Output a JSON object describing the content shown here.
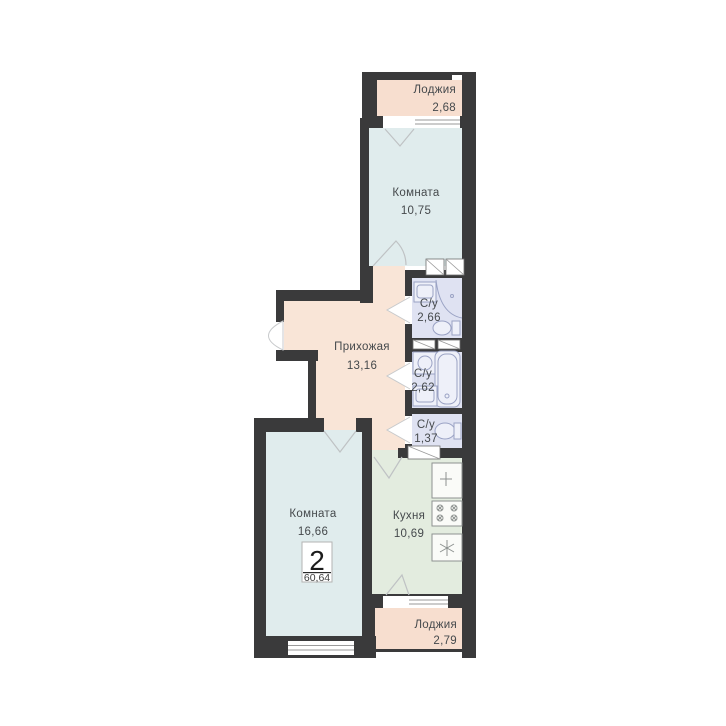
{
  "plan": {
    "type": "apartment-floor-plan",
    "badge": {
      "rooms_count": "2",
      "total_area": "60,64"
    },
    "rooms": [
      {
        "id": "loggia-top",
        "label": "Лоджия",
        "area": "2,68"
      },
      {
        "id": "room-top",
        "label": "Комната",
        "area": "10,75"
      },
      {
        "id": "bathroom-1",
        "label": "С/у",
        "area": "2,66"
      },
      {
        "id": "hallway",
        "label": "Прихожая",
        "area": "13,16"
      },
      {
        "id": "bathroom-2",
        "label": "С/у",
        "area": "2,62"
      },
      {
        "id": "bathroom-3",
        "label": "С/у",
        "area": "1,37"
      },
      {
        "id": "room-main",
        "label": "Комната",
        "area": "16,66"
      },
      {
        "id": "kitchen",
        "label": "Кухня",
        "area": "10,69"
      },
      {
        "id": "loggia-bottom",
        "label": "Лоджия",
        "area": "2,79"
      }
    ],
    "colors": {
      "wall": "#3a3a3b",
      "room": "#e0eced",
      "loggia": "#f7decf",
      "hallway": "#f9e5d7",
      "bathroom": "#dfe2f2",
      "kitchen": "#e3ecdf"
    },
    "fixtures": [
      "sink",
      "shower",
      "toilet",
      "washing-machine",
      "bathtub",
      "kitchen-sink",
      "stove",
      "fridge",
      "wardrobe",
      "window",
      "door"
    ]
  }
}
